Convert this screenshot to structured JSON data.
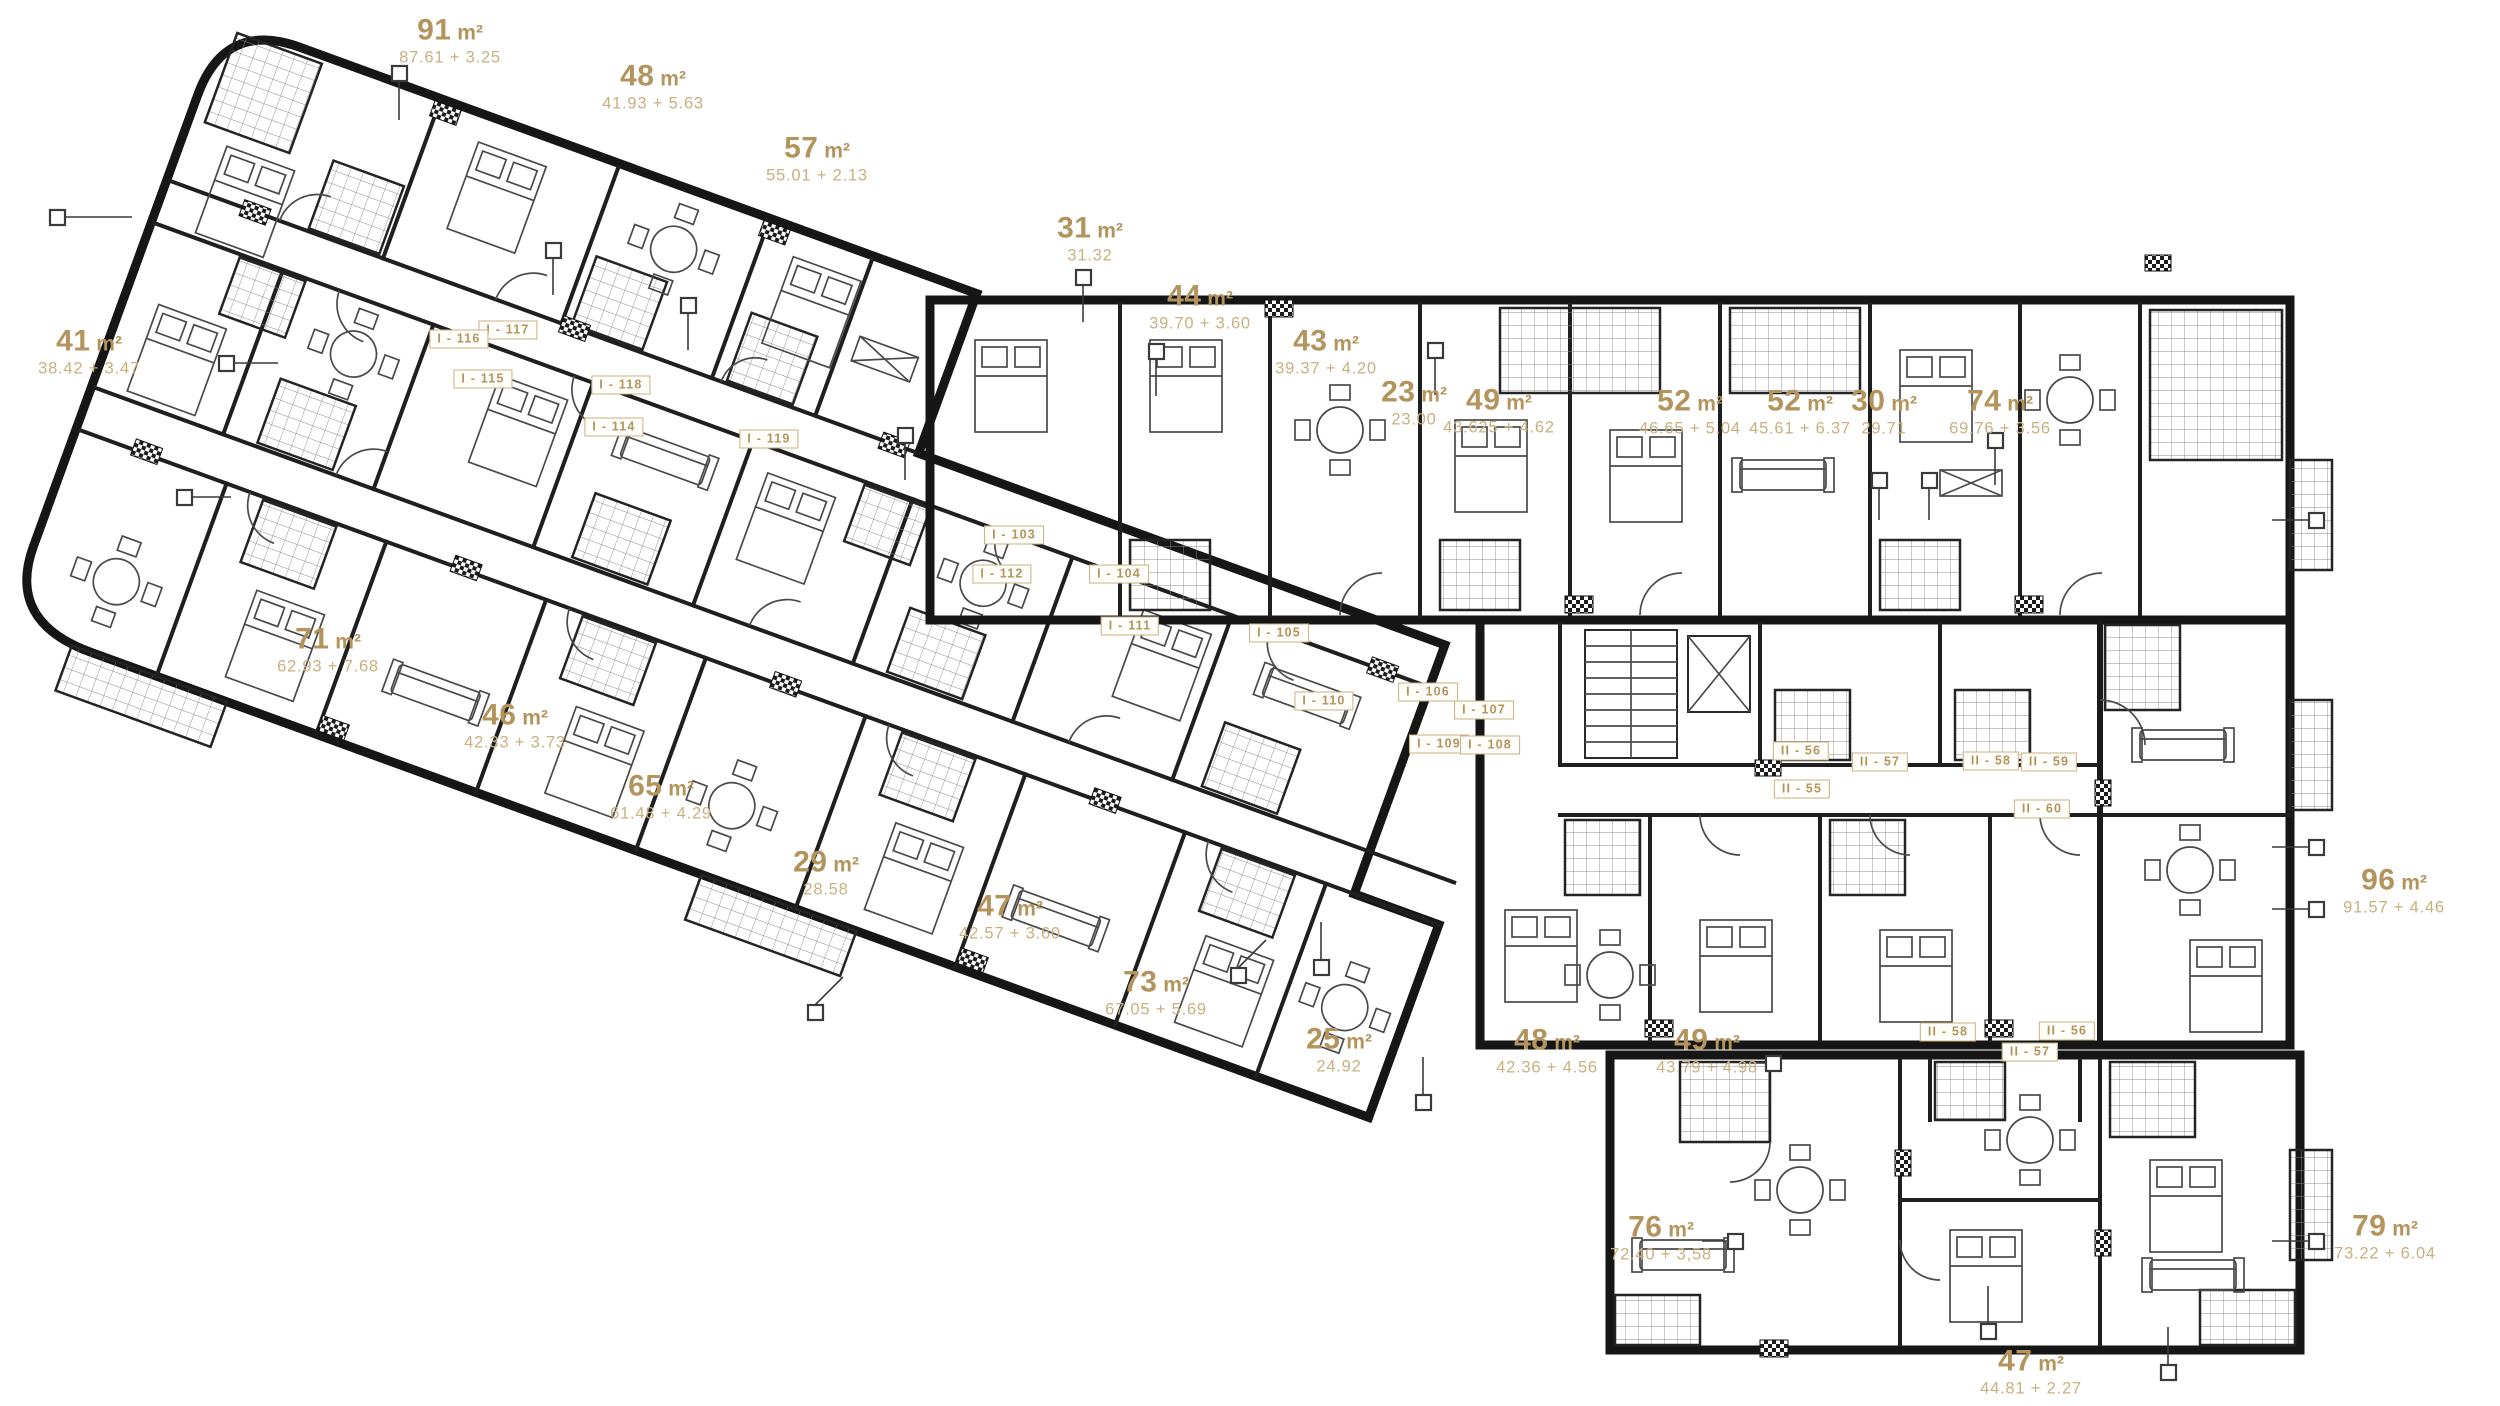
{
  "colors": {
    "gold_bold": "#b3945c",
    "gold_light": "#c9b081",
    "wall": "#161616",
    "background": "#ffffff"
  },
  "plan": {
    "area_labels": [
      {
        "area": "91",
        "unit": "m²",
        "formula": "87.61 + 3.25",
        "x": 450,
        "y": 41
      },
      {
        "area": "48",
        "unit": "m²",
        "formula": "41.93 + 5.63",
        "x": 653,
        "y": 87
      },
      {
        "area": "57",
        "unit": "m²",
        "formula": "55.01 + 2.13",
        "x": 817,
        "y": 159
      },
      {
        "area": "31",
        "unit": "m²",
        "formula": "31.32",
        "x": 1090,
        "y": 239
      },
      {
        "area": "44",
        "unit": "m²",
        "formula": "39.70 + 3.60",
        "x": 1200,
        "y": 307
      },
      {
        "area": "43",
        "unit": "m²",
        "formula": "39.37 + 4.20",
        "x": 1326,
        "y": 352
      },
      {
        "area": "23",
        "unit": "m²",
        "formula": "23.00",
        "x": 1414,
        "y": 403
      },
      {
        "area": "49",
        "unit": "m²",
        "formula": "43.625 + 4.62",
        "x": 1499,
        "y": 411
      },
      {
        "area": "52",
        "unit": "m²",
        "formula": "46.65 + 5.04",
        "x": 1690,
        "y": 412
      },
      {
        "area": "52",
        "unit": "m²",
        "formula": "45.61 + 6.37",
        "x": 1800,
        "y": 412
      },
      {
        "area": "30",
        "unit": "m²",
        "formula": "29.71",
        "x": 1884,
        "y": 412
      },
      {
        "area": "74",
        "unit": "m²",
        "formula": "69.76 + 3.56",
        "x": 2000,
        "y": 412
      },
      {
        "area": "41",
        "unit": "m²",
        "formula": "38.42 + 3.47",
        "x": 89,
        "y": 352
      },
      {
        "area": "71",
        "unit": "m²",
        "formula": "62.93 + 7.68",
        "x": 328,
        "y": 650
      },
      {
        "area": "46",
        "unit": "m²",
        "formula": "42.33 + 3.73",
        "x": 515,
        "y": 726
      },
      {
        "area": "65",
        "unit": "m²",
        "formula": "61.48 + 4.29",
        "x": 661,
        "y": 797
      },
      {
        "area": "29",
        "unit": "m²",
        "formula": "28.58",
        "x": 826,
        "y": 873
      },
      {
        "area": "47",
        "unit": "m²",
        "formula": "42.57 + 3.60",
        "x": 1010,
        "y": 917
      },
      {
        "area": "73",
        "unit": "m²",
        "formula": "67.05 + 5.69",
        "x": 1156,
        "y": 993
      },
      {
        "area": "25",
        "unit": "m²",
        "formula": "24.92",
        "x": 1339,
        "y": 1050
      },
      {
        "area": "48",
        "unit": "m²",
        "formula": "42.36 + 4.56",
        "x": 1547,
        "y": 1051
      },
      {
        "area": "49",
        "unit": "m²",
        "formula": "43.79 + 4.98",
        "x": 1707,
        "y": 1051
      },
      {
        "area": "96",
        "unit": "m²",
        "formula": "91.57 + 4.46",
        "x": 2394,
        "y": 891
      },
      {
        "area": "76",
        "unit": "m²",
        "formula": "72.40 + 3,58",
        "x": 1661,
        "y": 1238
      },
      {
        "area": "79",
        "unit": "m²",
        "formula": "73.22 + 6.04",
        "x": 2385,
        "y": 1237
      },
      {
        "area": "47",
        "unit": "m²",
        "formula": "44.81 + 2.27",
        "x": 2031,
        "y": 1372
      }
    ],
    "unit_tags": [
      {
        "text": "I - 117",
        "x": 508,
        "y": 330
      },
      {
        "text": "I - 116",
        "x": 459,
        "y": 339
      },
      {
        "text": "I - 115",
        "x": 483,
        "y": 379
      },
      {
        "text": "I - 118",
        "x": 621,
        "y": 385
      },
      {
        "text": "I - 114",
        "x": 614,
        "y": 427
      },
      {
        "text": "I - 119",
        "x": 769,
        "y": 439
      },
      {
        "text": "I - 103",
        "x": 1014,
        "y": 535
      },
      {
        "text": "I - 112",
        "x": 1002,
        "y": 574
      },
      {
        "text": "I - 104",
        "x": 1119,
        "y": 574
      },
      {
        "text": "I - 111",
        "x": 1130,
        "y": 626
      },
      {
        "text": "I - 105",
        "x": 1279,
        "y": 633
      },
      {
        "text": "I - 110",
        "x": 1324,
        "y": 701
      },
      {
        "text": "I - 106",
        "x": 1428,
        "y": 692
      },
      {
        "text": "I - 107",
        "x": 1484,
        "y": 710
      },
      {
        "text": "I - 109",
        "x": 1439,
        "y": 744
      },
      {
        "text": "I - 108",
        "x": 1490,
        "y": 745
      },
      {
        "text": "II - 56",
        "x": 1801,
        "y": 751
      },
      {
        "text": "II - 57",
        "x": 1880,
        "y": 762
      },
      {
        "text": "II - 58",
        "x": 1991,
        "y": 761
      },
      {
        "text": "II - 59",
        "x": 2049,
        "y": 762
      },
      {
        "text": "II - 55",
        "x": 1802,
        "y": 789
      },
      {
        "text": "II - 60",
        "x": 2042,
        "y": 809
      },
      {
        "text": "II - 58",
        "x": 1948,
        "y": 1032
      },
      {
        "text": "II - 56",
        "x": 2067,
        "y": 1031
      },
      {
        "text": "II - 57",
        "x": 2030,
        "y": 1052
      }
    ]
  }
}
